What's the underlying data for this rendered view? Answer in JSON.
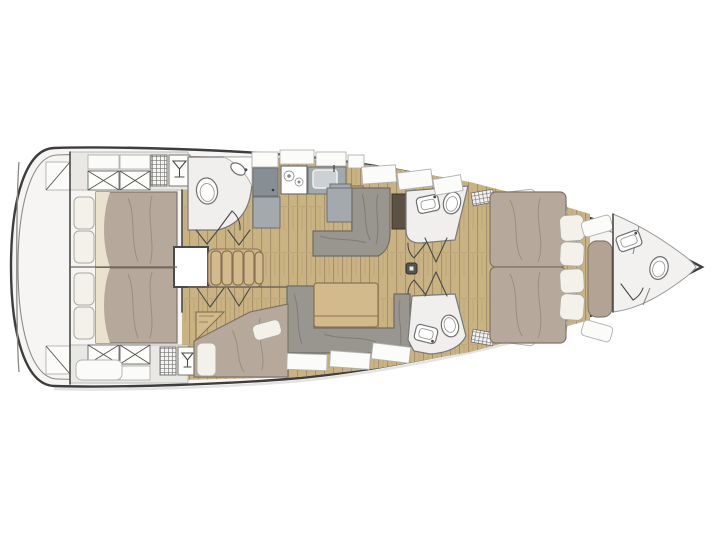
{
  "diagram": {
    "type": "yacht-floorplan-top-view",
    "orientation": "bow-right",
    "visible_text": [],
    "areas": [
      {
        "name": "stern-platform"
      },
      {
        "name": "aft-cabin-starboard",
        "furniture": [
          "double-bed",
          "pillows",
          "locker-x",
          "hanging-locker",
          "wet-locker"
        ]
      },
      {
        "name": "aft-cabin-port",
        "furniture": [
          "double-bed",
          "pillows",
          "locker-x",
          "hanging-locker",
          "wet-locker"
        ]
      },
      {
        "name": "aft-head",
        "furniture": [
          "toilet",
          "sink",
          "shower-wall"
        ]
      },
      {
        "name": "galley",
        "furniture": [
          "fridge",
          "stove-two-burners",
          "sink",
          "counters",
          "overhead-lockers"
        ]
      },
      {
        "name": "companionway",
        "furniture": [
          "engine-box",
          "steps"
        ]
      },
      {
        "name": "salon",
        "furniture": [
          "l-settee",
          "chart-locker"
        ]
      },
      {
        "name": "dinette",
        "furniture": [
          "u-settee",
          "folding-table"
        ]
      },
      {
        "name": "mid-cabin-port",
        "furniture": [
          "angled-double-bed",
          "pillows",
          "corner-shelf"
        ]
      },
      {
        "name": "forward-head-starboard",
        "furniture": [
          "toilet",
          "sink"
        ]
      },
      {
        "name": "forward-head-port",
        "furniture": [
          "toilet",
          "sink"
        ]
      },
      {
        "name": "owner-cabin",
        "furniture": [
          "island-double-bed",
          "pillows",
          "seat-bench",
          "side-cushions"
        ]
      },
      {
        "name": "bow-head",
        "furniture": [
          "toilet",
          "sink"
        ]
      }
    ],
    "icons": [
      "toilet-icon",
      "sink-icon",
      "stove-burner-icon",
      "martini-glass-locker-icon",
      "hanging-locker-grid-icon",
      "vent-grille-icon",
      "mast-step-icon",
      "door-swing-icon",
      "locker-x-icon"
    ]
  },
  "colors": {
    "hull-fill": "#f6f5f3",
    "hull-line": "#3d3d3d",
    "inner-line": "#8a8a88",
    "deck-band": "#e9e8e5",
    "deck-band-line": "#b0afac",
    "wood-floor": "#c9b383",
    "wood-line": "#a8906a",
    "furniture-wood": "#d3ba8d",
    "furniture-wood-line": "#8a7354",
    "mattress": "#b6a99b",
    "mattress-line": "#7d7468",
    "mattress-fold": "#eae2cf",
    "pillow": "#f3f1ea",
    "pillow-line": "#acaa9e",
    "settee": "#98968e",
    "settee-line": "#6e6c64",
    "counter": "#a3a9ad",
    "counter-line": "#6b7074",
    "appliance": "#878f94",
    "dark-wood": "#5d5144",
    "bench": "#b3a394",
    "bench-line": "#877a6b",
    "room": "#f0efed",
    "room-line": "#79797a",
    "wall": "#4a4a48",
    "fixture-line": "#707070",
    "panel": "#fbfbfa",
    "panel-line": "#b2b1ae",
    "shadow": "#d8d7d5",
    "background": "#ffffff"
  }
}
